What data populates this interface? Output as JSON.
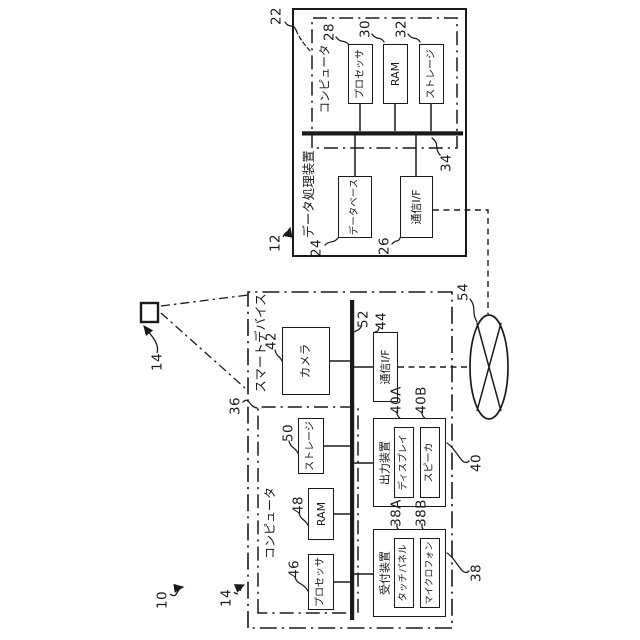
{
  "figure": {
    "system_ref": "10",
    "device_icon_ref": "14",
    "device_box_ref": "14"
  },
  "data_processing_device": {
    "label": "データ処理装置",
    "ref": "12",
    "computer": {
      "label": "コンピュータ",
      "ref": "22",
      "processor": {
        "label": "プロセッサ",
        "ref": "28"
      },
      "ram": {
        "label": "RAM",
        "ref": "30"
      },
      "storage": {
        "label": "ストレージ",
        "ref": "32"
      }
    },
    "bus_ref": "34",
    "database": {
      "label": "データベース",
      "ref": "24"
    },
    "comm_if": {
      "label": "通信I/F",
      "ref": "26"
    }
  },
  "smart_device": {
    "label": "スマートデバイス",
    "computer": {
      "label": "コンピュータ",
      "ref": "36",
      "processor": {
        "label": "プロセッサ",
        "ref": "46"
      },
      "ram": {
        "label": "RAM",
        "ref": "48"
      },
      "storage": {
        "label": "ストレージ",
        "ref": "50"
      }
    },
    "camera": {
      "label": "カメラ",
      "ref": "42"
    },
    "bus_ref": "52",
    "comm_if": {
      "label": "通信I/F",
      "ref": "44"
    },
    "output_device": {
      "label": "出力装置",
      "ref": "40",
      "display": {
        "label": "ディスプレイ",
        "ref": "40A"
      },
      "speaker": {
        "label": "スピーカ",
        "ref": "40B"
      }
    },
    "input_device": {
      "label": "受付装置",
      "ref": "38",
      "touch_panel": {
        "label": "タッチパネル",
        "ref": "38A"
      },
      "microphone": {
        "label": "マイクロフォン",
        "ref": "38B"
      }
    }
  },
  "network": {
    "ref": "54"
  }
}
